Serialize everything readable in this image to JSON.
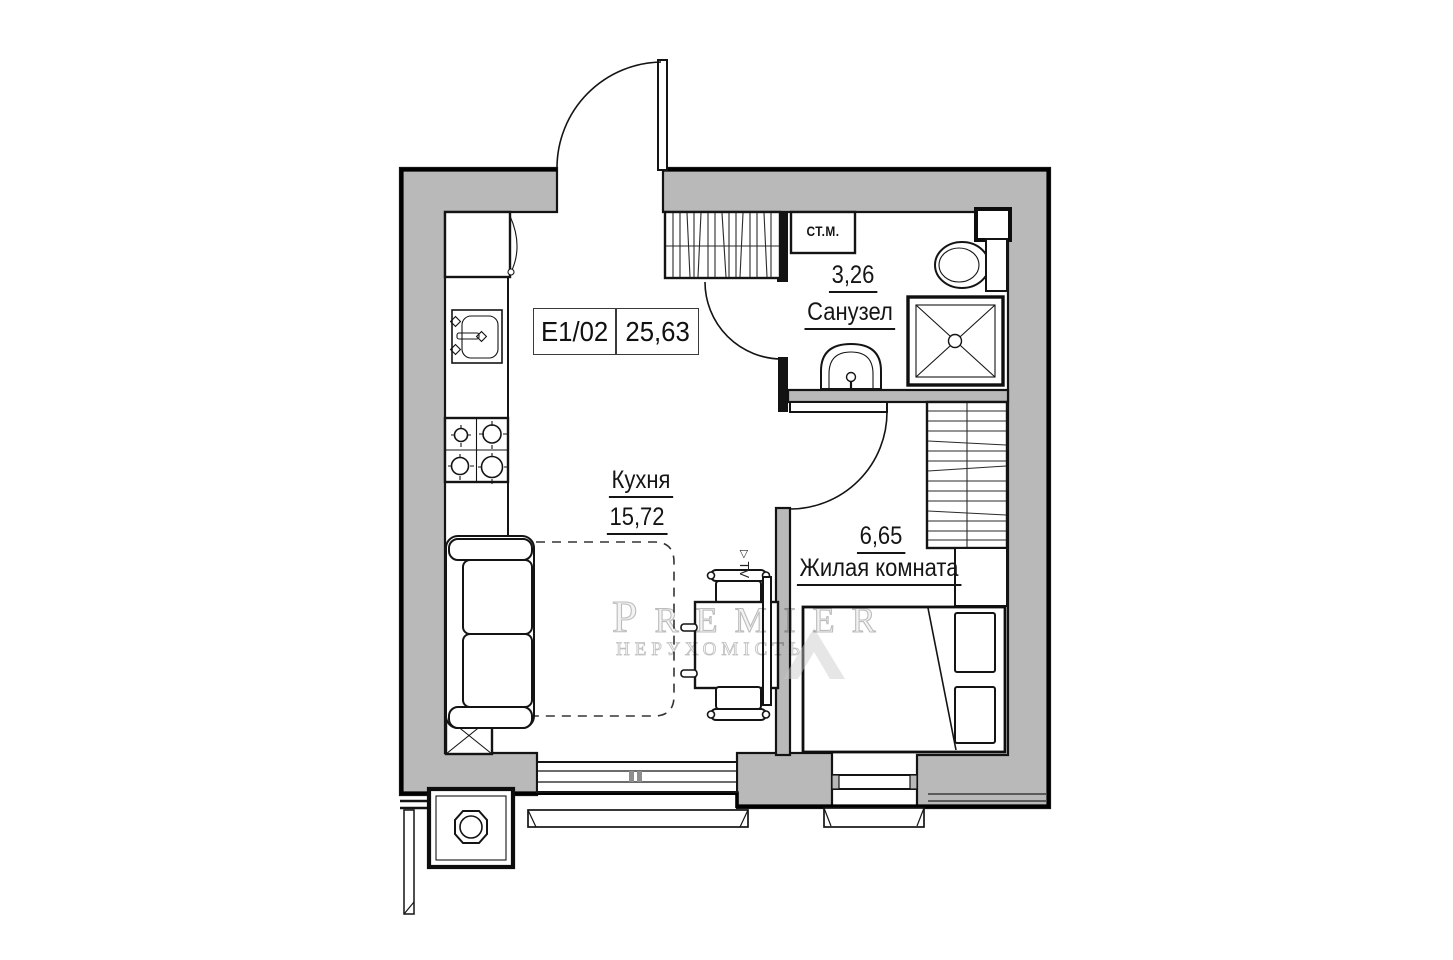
{
  "plan": {
    "unit_box": {
      "code": "E1/02",
      "total_area": "25,63"
    },
    "rooms": {
      "kitchen": {
        "name": "Кухня",
        "area": "15,72"
      },
      "bathroom": {
        "name": "Санузел",
        "area": "3,26"
      },
      "living_room": {
        "name": "Жилая комната",
        "area": "6,65"
      }
    },
    "labels": {
      "washing_machine": "СТ.М.",
      "tv": "TV",
      "tv_marker": "▷"
    },
    "watermark": {
      "brand": "PREMIER",
      "tagline": "НЕРУХОМІСТЬ"
    }
  },
  "colors": {
    "wall_fill": "#b9b9b9",
    "line": "#131313",
    "watermark": "#c8c8c8"
  }
}
